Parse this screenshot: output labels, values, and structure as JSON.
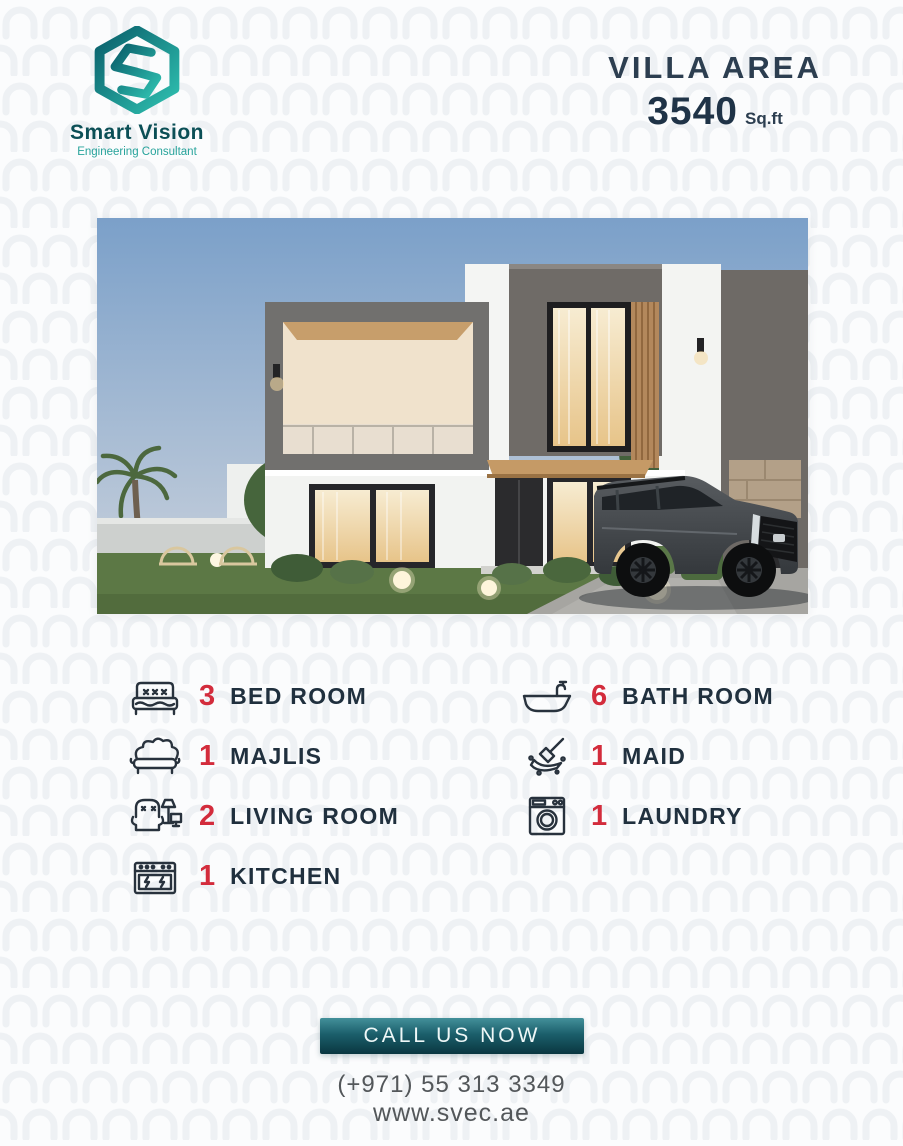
{
  "brand": {
    "name": "Smart Vision",
    "tagline": "Engineering Consultant"
  },
  "header": {
    "villa_area_label": "VILLA AREA",
    "area_value": "3540",
    "area_unit": "Sq.ft"
  },
  "features": {
    "left": [
      {
        "count": "3",
        "label": "BED ROOM",
        "icon": "bed-icon"
      },
      {
        "count": "1",
        "label": "MAJLIS",
        "icon": "sofa-icon"
      },
      {
        "count": "2",
        "label": "LIVING ROOM",
        "icon": "armchair-lamp-icon"
      },
      {
        "count": "1",
        "label": "KITCHEN",
        "icon": "stove-icon"
      }
    ],
    "right": [
      {
        "count": "6",
        "label": "BATH ROOM",
        "icon": "bathtub-icon"
      },
      {
        "count": "1",
        "label": "MAID",
        "icon": "cleaning-icon"
      },
      {
        "count": "1",
        "label": "LAUNDRY",
        "icon": "washing-machine-icon"
      }
    ]
  },
  "cta": {
    "button_label": "CALL US NOW",
    "phone": "(+971) 55 313 3349",
    "website": "www.svec.ae"
  },
  "colors": {
    "accent_red": "#d32c3c",
    "navy": "#20303e",
    "teal_dark": "#0b4f56",
    "teal_light": "#2fc0b0",
    "button_top": "#43909a",
    "button_bottom": "#0a3640"
  }
}
